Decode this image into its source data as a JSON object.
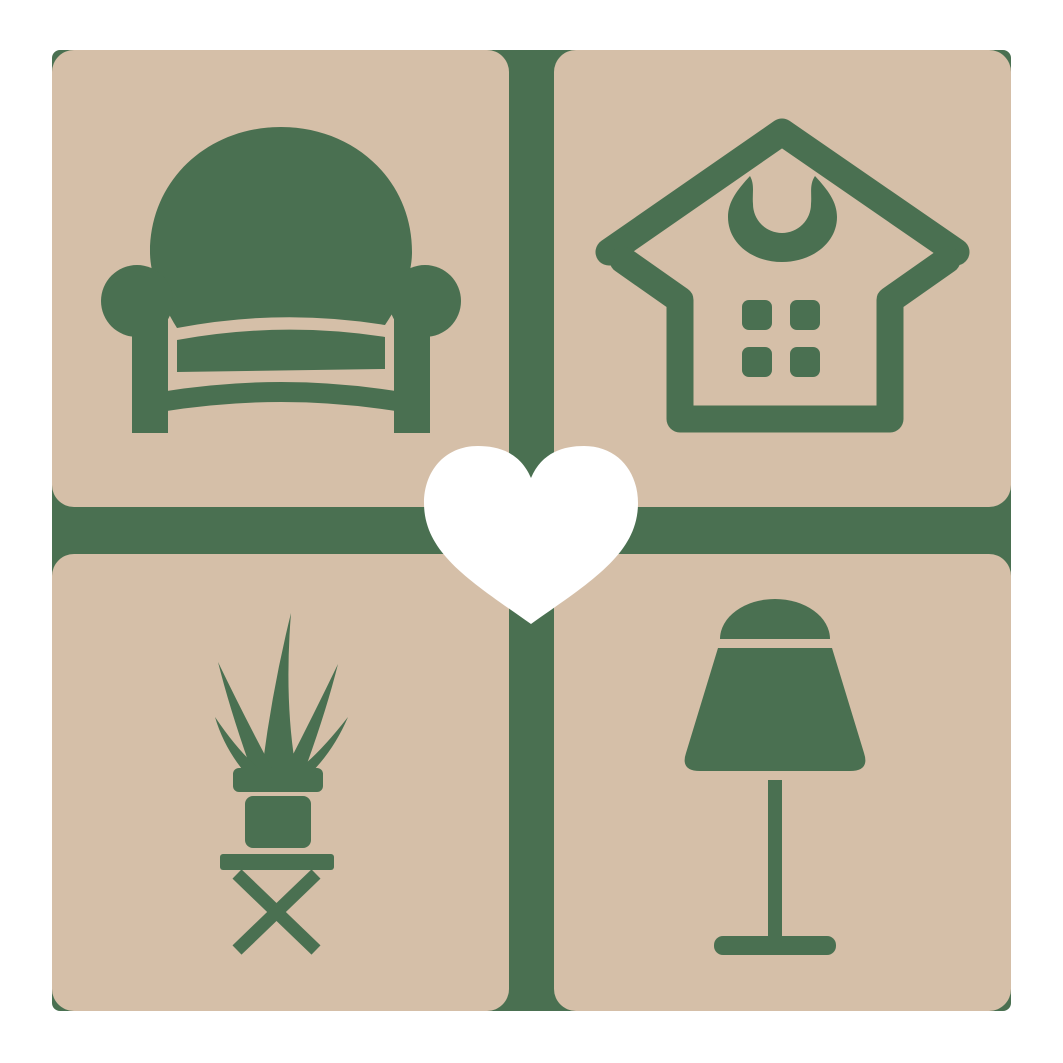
{
  "logo": {
    "name": "home-decor-heart-logo",
    "colors": {
      "green": "#4a7051",
      "tan": "#d5bfa8",
      "heart": "#ffffff"
    },
    "tiles": [
      {
        "name": "armchair",
        "position": "top-left"
      },
      {
        "name": "house",
        "position": "top-right"
      },
      {
        "name": "potted-plant",
        "position": "bottom-left"
      },
      {
        "name": "table-lamp",
        "position": "bottom-right"
      }
    ],
    "center": {
      "name": "heart"
    }
  }
}
